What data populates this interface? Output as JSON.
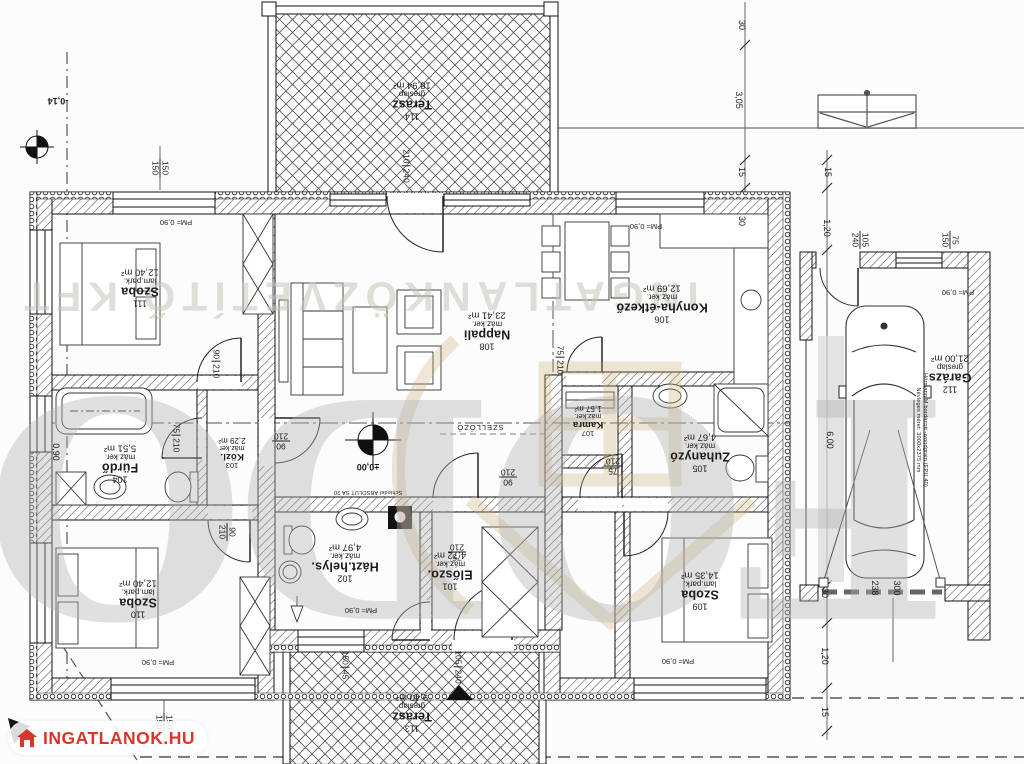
{
  "rooms": [
    {
      "number": "114",
      "name": "Terasz",
      "floor": "greslap",
      "area": "18,94 m²"
    },
    {
      "number": "111",
      "name": "Szoba",
      "floor": "lam.park.",
      "area": "12,40 m²"
    },
    {
      "number": "108",
      "name": "Nappali",
      "floor": "máz.ker.",
      "area": "23,41 m²"
    },
    {
      "number": "106",
      "name": "Konyha-étkező",
      "floor": "máz.ker.",
      "area": "12,69 m²"
    },
    {
      "number": "107",
      "name": "Kamra",
      "floor": "máz.ker.",
      "area": "1,57 m²"
    },
    {
      "number": "105",
      "name": "Zuhanyzó",
      "floor": "máz.ker.",
      "area": "4,67 m²"
    },
    {
      "number": "104",
      "name": "Fürdő",
      "floor": "máz.ker.",
      "area": "5,51 m²"
    },
    {
      "number": "103",
      "name": "Közl.",
      "floor": "máz.ker",
      "area": "2,29 m²"
    },
    {
      "number": "102",
      "name": "Házt.helys.",
      "floor": "máz.ker.",
      "area": "4,97 m²"
    },
    {
      "number": "101",
      "name": "Előszo.",
      "floor": "máz.ker.",
      "area": "4,72 m²"
    },
    {
      "number": "110",
      "name": "Szoba",
      "floor": "lam.park.",
      "area": "12,40 m²"
    },
    {
      "number": "109",
      "name": "Szoba",
      "floor": "lam.park.",
      "area": "14,35 m²"
    },
    {
      "number": "112",
      "name": "Garázs",
      "floor": "greslap",
      "area": "21,00 m²"
    },
    {
      "number": "113",
      "name": "Terasz",
      "floor": "greslap",
      "area": "9,40 m²"
    }
  ],
  "pairs": [
    {
      "w": "90",
      "h": "210"
    },
    {
      "w": "90",
      "h": "210"
    },
    {
      "w": "90",
      "h": "210"
    },
    {
      "w": "75",
      "h": "210"
    },
    {
      "w": "90",
      "h": "210"
    },
    {
      "w": "75",
      "h": "210"
    },
    {
      "w": "75",
      "h": "210"
    },
    {
      "w": "75",
      "h": "210"
    },
    {
      "w": "210",
      "h": "240"
    },
    {
      "w": "105",
      "h": "240"
    },
    {
      "w": "105",
      "h": "240"
    },
    {
      "w": "150",
      "h": "45"
    },
    {
      "w": "150",
      "h": "150"
    },
    {
      "w": "75",
      "h": "150"
    },
    {
      "w": "150",
      "h": "150"
    }
  ],
  "dims": [
    {
      "t": "30"
    },
    {
      "t": "3,05"
    },
    {
      "t": "15"
    },
    {
      "t": "30"
    },
    {
      "t": "15"
    },
    {
      "t": "1,20"
    },
    {
      "t": "6,00"
    },
    {
      "t": "30"
    },
    {
      "t": "238"
    },
    {
      "t": "300"
    },
    {
      "t": "1,20"
    },
    {
      "t": "15"
    },
    {
      "t": "0,90"
    }
  ],
  "pm": [
    {
      "t": "PM= 0,90"
    },
    {
      "t": "PM= 0,90"
    },
    {
      "t": "PM= 0,90"
    },
    {
      "t": "PM= 0,90"
    },
    {
      "t": "PM= 0,90"
    },
    {
      "t": "PM= 0,90"
    }
  ],
  "levels": {
    "outside": "-0,14",
    "inside": "±0,00"
  },
  "annotations": {
    "vent": "SZELLŐZŐ",
    "chimney": "Schiedel ABSOLUT SA 20",
    "garage_door_line1": "Hörmann M bordázott -woodgrain (EPU 40)",
    "garage_door_line2": "Névleges méret: 3000x2375 mm"
  },
  "watermarks": {
    "agency": "INGATLANKÖZVETÍTŐ KFT",
    "brand": "FODOR",
    "logo": "INGATLANOK.HU"
  }
}
